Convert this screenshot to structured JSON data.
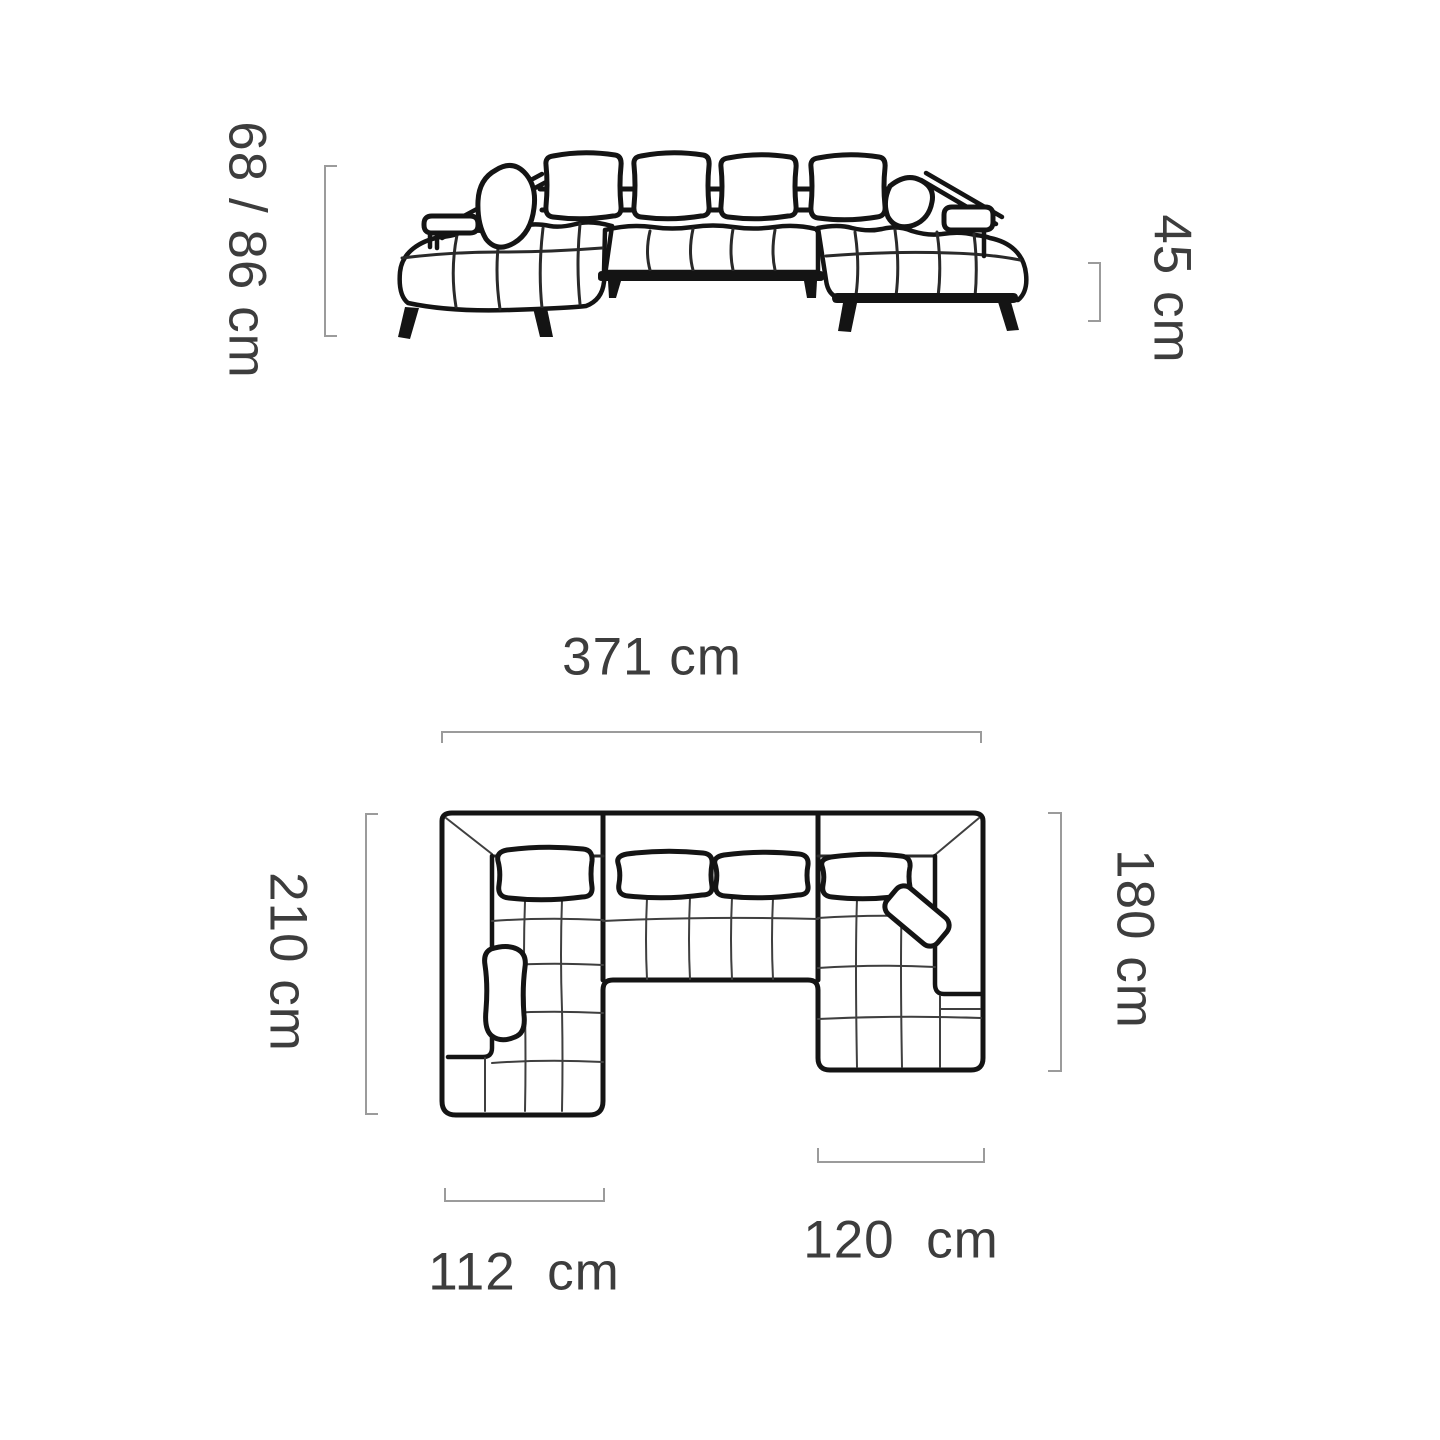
{
  "colors": {
    "background": "#ffffff",
    "drawing_line": "#141414",
    "seam_line": "#3f3f3f",
    "bracket": "#9b9b9b",
    "label_text": "#3d3d3d"
  },
  "front_view": {
    "name": "sofa front elevation drawing",
    "dim_height_total": {
      "label": "68 / 86 cm"
    },
    "dim_height_seat": {
      "label": "45 cm"
    }
  },
  "plan_view": {
    "name": "sofa top plan drawing",
    "dim_width_total": {
      "label": "371 cm"
    },
    "dim_depth_left": {
      "label": "210 cm"
    },
    "dim_depth_right": {
      "label": "180 cm"
    },
    "dim_chaise_left": {
      "label": "112  cm"
    },
    "dim_chaise_right": {
      "label": "120  cm"
    }
  }
}
